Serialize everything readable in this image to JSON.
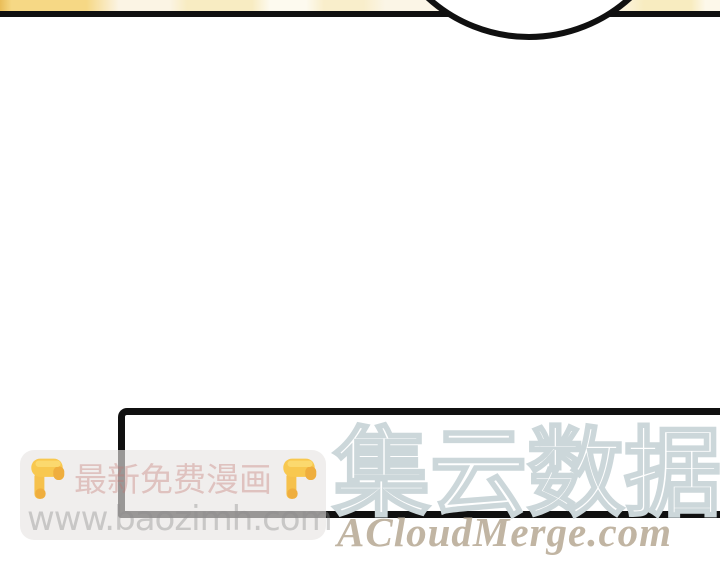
{
  "panel": {
    "divider_color": "#101010",
    "tile_colors": [
      "#f6d885",
      "#fbf4e4",
      "#f8ecc2",
      "#f9eecb",
      "#fbf3dc",
      "#f8ecc0"
    ]
  },
  "speech": {
    "circle_border_color": "#101010",
    "box_border_color": "#101010",
    "box_fill": "#ffffff"
  },
  "site_watermark": {
    "promo_text": "最新免费漫画",
    "left_icon": "backhand-index-pointing-down",
    "right_icon": "backhand-index-pointing-down",
    "url": "www.baozimh.com",
    "bubble_color": "#e7e5e3",
    "promo_color": "#c1756e",
    "url_color": "#8c8c8c"
  },
  "brand_watermark": {
    "name": "集云数据",
    "domain": "ACloudMerge.com",
    "outline_color": "#ccd7da",
    "fill_color": "#ffffff",
    "domain_color": "#c1b5a3"
  }
}
